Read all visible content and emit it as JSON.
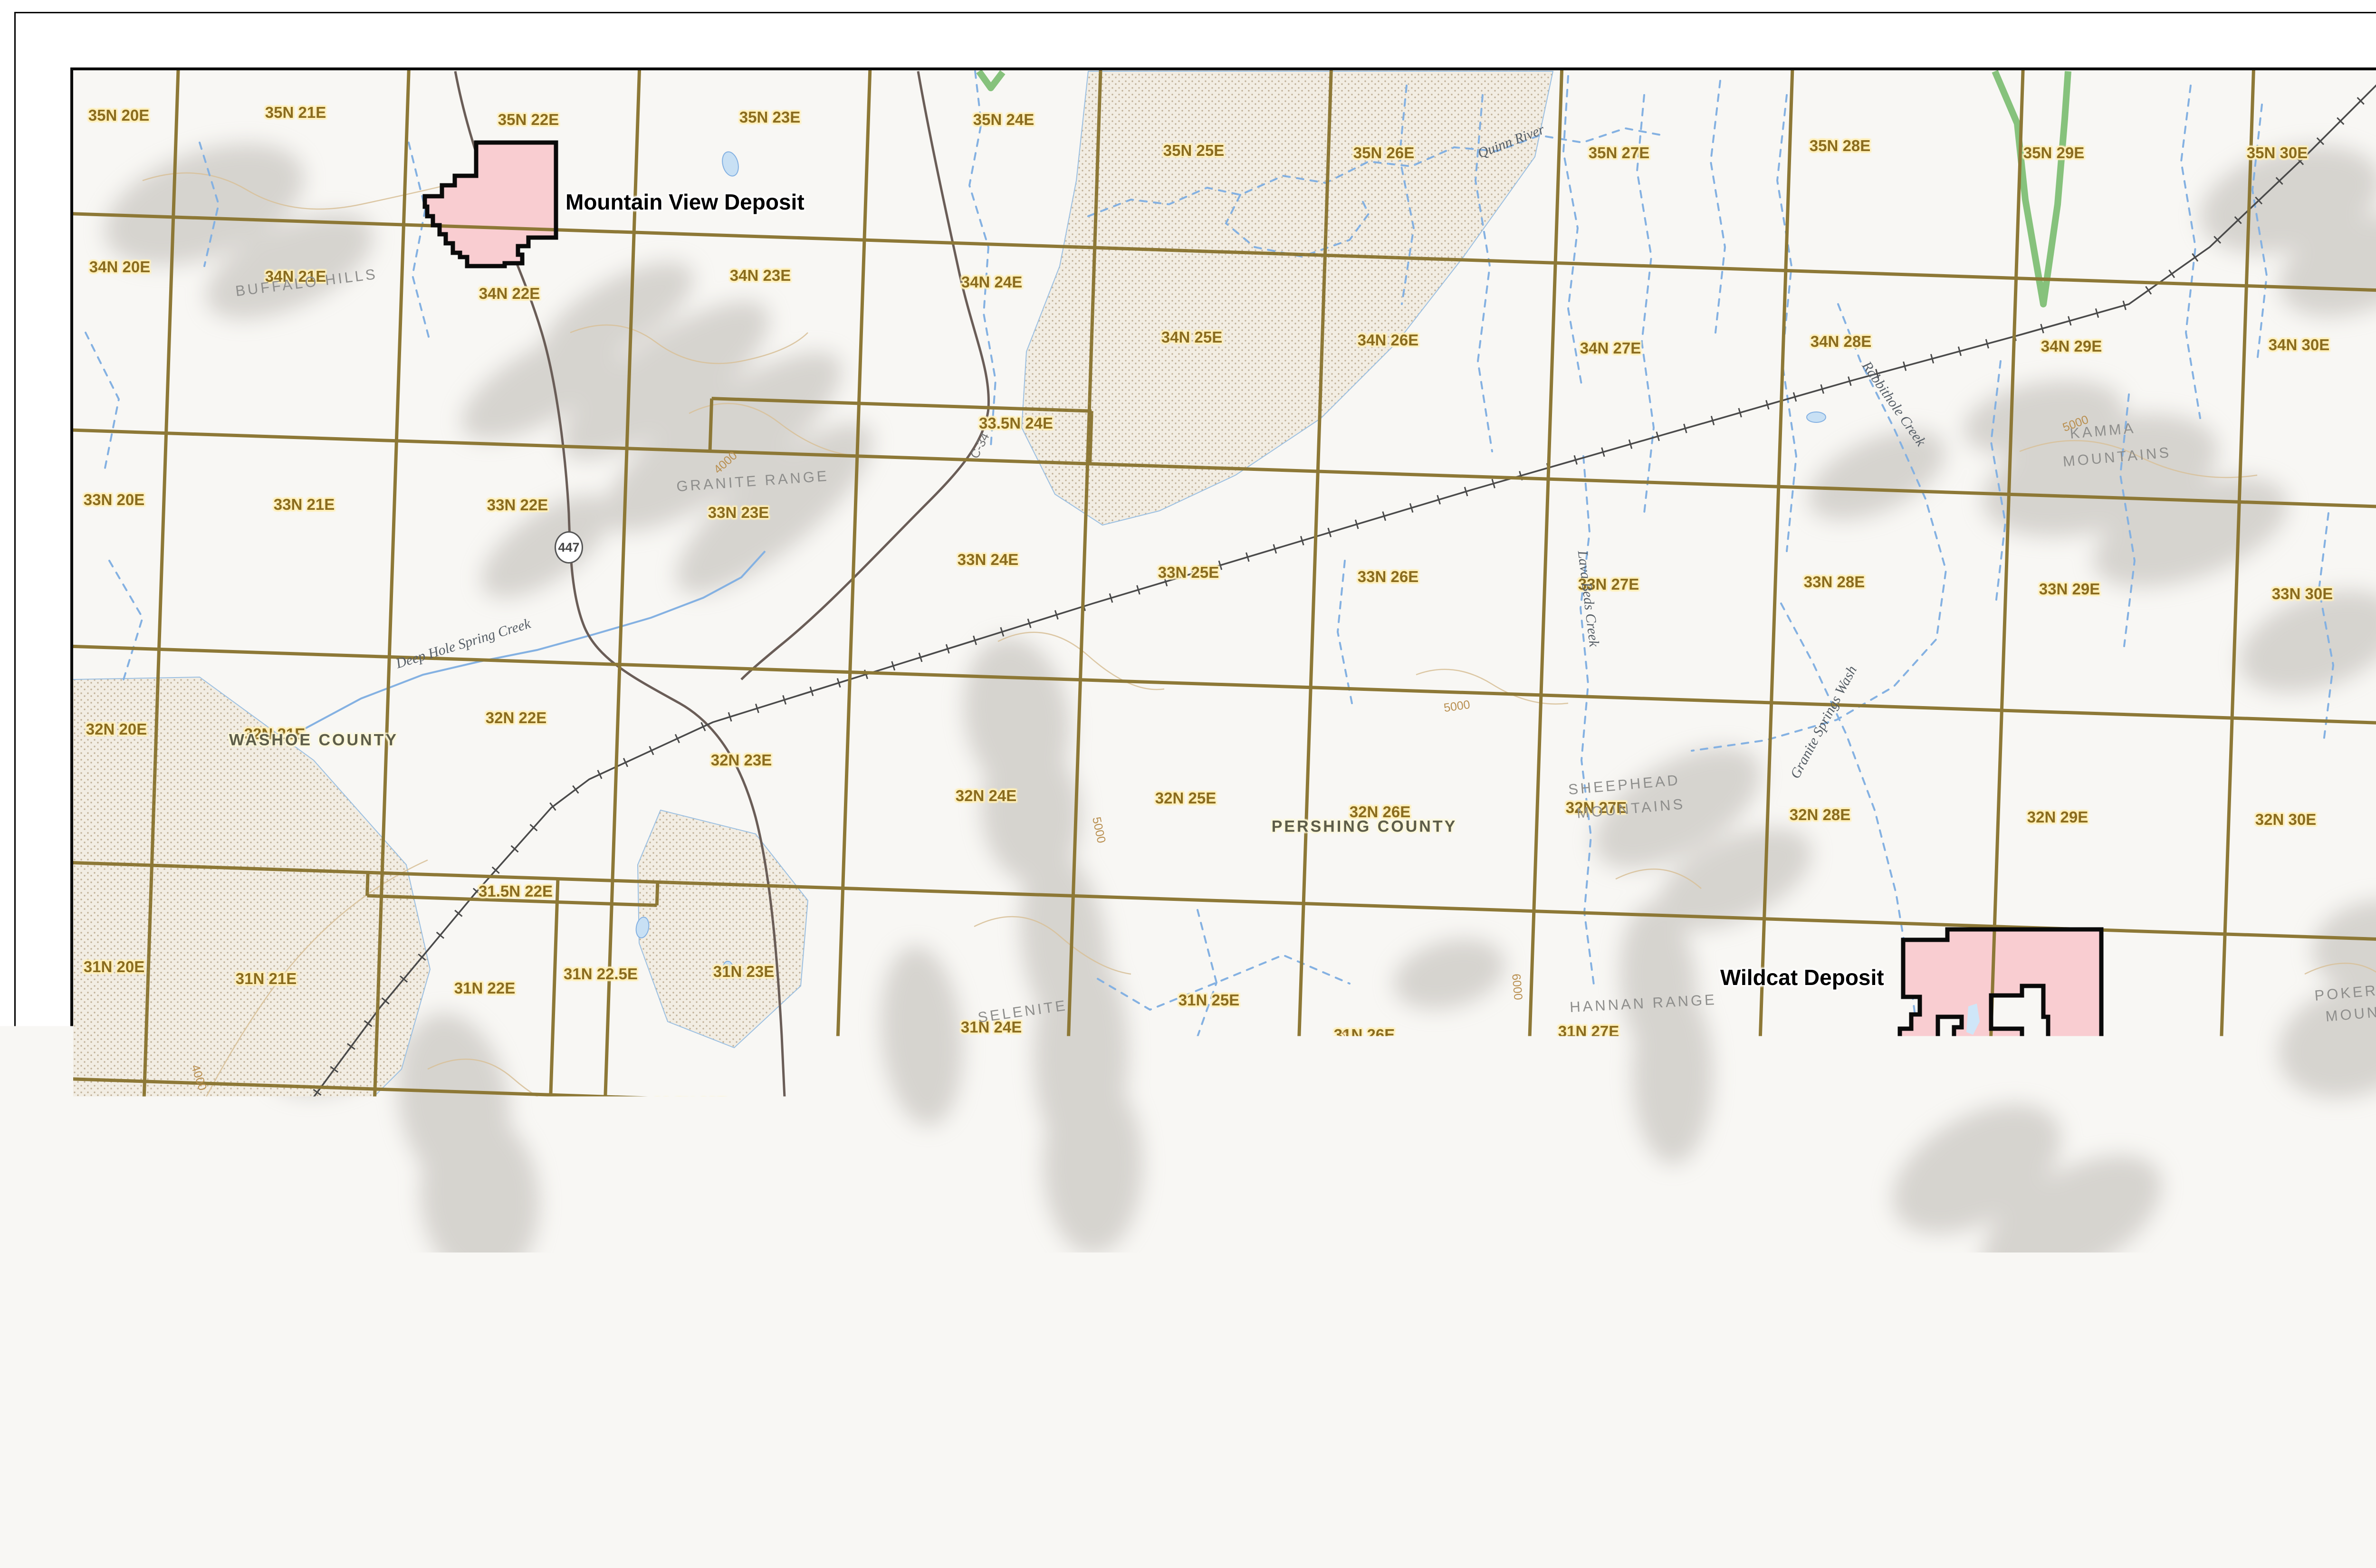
{
  "map": {
    "deposit_labels": [
      "Mountain View Deposit",
      "Wildcat Deposit"
    ],
    "township_labels": [
      "35N 20E",
      "35N 21E",
      "35N 22E",
      "35N 23E",
      "35N 24E",
      "35N 25E",
      "35N 26E",
      "35N 27E",
      "35N 28E",
      "35N 29E",
      "35N 30E",
      "34N 20E",
      "34N 21E",
      "34N 22E",
      "34N 23E",
      "34N 24E",
      "34N 25E",
      "34N 26E",
      "34N 27E",
      "34N 28E",
      "34N 29E",
      "34N 30E",
      "33.5N 24E",
      "33N 20E",
      "33N 21E",
      "33N 22E",
      "33N 23E",
      "33N 24E",
      "33N 25E",
      "33N 26E",
      "33N 27E",
      "33N 28E",
      "33N 29E",
      "33N 30E",
      "32N 20E",
      "32N 21E",
      "32N 22E",
      "32N 23E",
      "32N 24E",
      "32N 25E",
      "32N 26E",
      "32N 27E",
      "32N 28E",
      "32N 29E",
      "32N 30E",
      "31.5N 22E",
      "31N 20E",
      "31N 21E",
      "31N 22E",
      "31N 22.5E",
      "31N 23E",
      "31N 24E",
      "31N 25E",
      "31N 26E",
      "31N 27E",
      "31N 28E",
      "31N 29E",
      "31N 30E",
      "30.5N 23E",
      "30.5N 23.5E",
      "20E",
      "30N 21E",
      "30N 22E",
      "30N 23E",
      "30N 23.5E",
      "30N 24E",
      "30N 25E",
      "30N 26E",
      "30N 27E",
      "30N 28E",
      "30N 29E",
      "30N 30E"
    ],
    "geo_labels": [
      "BUFFALO HILLS",
      "GRANITE RANGE",
      "KAMMA",
      "MOUNTAINS",
      "SHEEPHEAD",
      "MOUNTAINS",
      "SELENITE",
      "RANGE",
      "HANNAN RANGE",
      "POKER BRO",
      "MOUNTAIN",
      "SEVEN",
      "TROUGHS"
    ],
    "county_labels": [
      "WASHOE COUNTY",
      "PERSHING COUNTY"
    ],
    "water_labels": [
      "Quinn River",
      "Rabbithole Creek",
      "Deep Hole Spring Creek",
      "Lava Beds Creek",
      "Granite Springs Wash"
    ],
    "contour_labels": [
      "4000",
      "4000",
      "5000",
      "5000",
      "5000",
      "6000",
      "6000",
      "5000",
      "7000"
    ],
    "road_labels": [
      "447",
      "C-34"
    ]
  },
  "legend": {
    "title": "Legend",
    "items": [
      {
        "label": "MNV Patented Claim",
        "color": "#c9e4f8"
      },
      {
        "label": "MNV Unpatented Claim",
        "color": "#f9cdd1"
      },
      {
        "label": "Property Boundary",
        "color": "#000000"
      },
      {
        "label": "Township - Range (PLSS)",
        "color": "#8d7836"
      }
    ]
  },
  "logo": {
    "line1": "INTEGRA",
    "line2": "NEVADA"
  },
  "scale_bar": {
    "start": "0",
    "end": "30,000",
    "unit": "Feet"
  },
  "north_arrow": "N",
  "scale_text": {
    "line1": "Scale: 1:240,000",
    "line2": "1 inch equals  20,000 feet"
  },
  "credits": [
    "WGS 84 UTM Zone 11 North Meters",
    "Imagery | Integra 2019",
    "Sources | Esri, BLM, USGS, Integra Resources 2021"
  ],
  "title_block": {
    "date": "2024-03-19",
    "company1": "Millennial NV LLC",
    "company2": "Integra Resources Corporation",
    "title_line1": "Nevada North Land Position",
    "title_line2": "Wildcat and Mountain View"
  },
  "footer": {
    "path_text": "Path: Z:\\Shared\\DMC_Data\\GIS_Data\\Reporting\\Annual_Report_20-F\\Annual_Report_20-F.aprx"
  }
}
